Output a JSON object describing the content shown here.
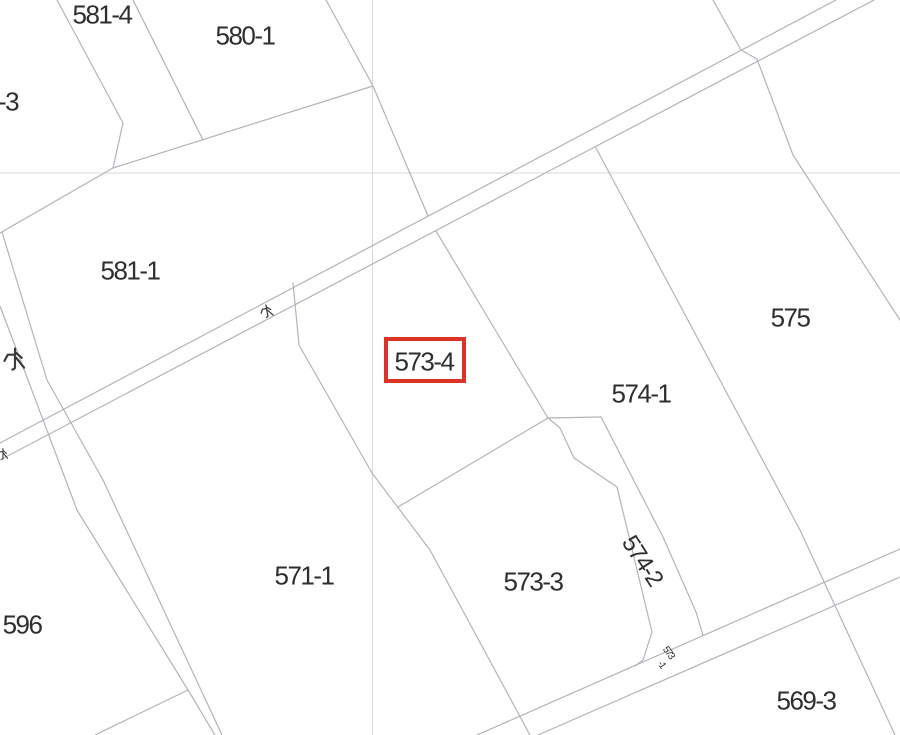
{
  "map": {
    "colors": {
      "background": "#ffffff",
      "boundary_line": "#b3b3b9",
      "grid_line": "#d9d9db",
      "label_text": "#2e2e2e",
      "highlight_red": "#dc3227"
    },
    "grid_lines": [
      {
        "name": "grid-vertical-line",
        "points": [
          [
            372.5,
            0
          ],
          [
            372.5,
            735
          ]
        ]
      },
      {
        "name": "grid-horizontal-line",
        "points": [
          [
            0,
            173
          ],
          [
            900,
            173
          ]
        ]
      }
    ],
    "boundaries": [
      {
        "name": "waterway-a-upper-line",
        "points": [
          [
            0,
            443
          ],
          [
            836,
            0
          ]
        ]
      },
      {
        "name": "waterway-a-lower-line",
        "points": [
          [
            0,
            460
          ],
          [
            874,
            0
          ]
        ]
      },
      {
        "name": "road-b-upper-line",
        "points": [
          [
            900,
            549
          ],
          [
            477,
            735
          ]
        ]
      },
      {
        "name": "road-b-lower-line",
        "points": [
          [
            900,
            577
          ],
          [
            538,
            735
          ]
        ]
      },
      {
        "name": "waterway-strip-west-line",
        "points": [
          [
            0,
            306
          ],
          [
            28,
            380
          ],
          [
            77,
            510
          ],
          [
            188,
            690
          ],
          [
            215,
            735
          ]
        ]
      },
      {
        "name": "waterway-strip-east-line",
        "points": [
          [
            2,
            232
          ],
          [
            47,
            380
          ],
          [
            103,
            480
          ],
          [
            222,
            735
          ]
        ]
      },
      {
        "name": "parcel-596-south-line",
        "points": [
          [
            188,
            690
          ],
          [
            95,
            735
          ]
        ]
      },
      {
        "name": "parcel-581-4-west-line",
        "points": [
          [
            57,
            0
          ],
          [
            123,
            123
          ],
          [
            113,
            168
          ]
        ]
      },
      {
        "name": "parcel-581-4-east-line",
        "points": [
          [
            133,
            0
          ],
          [
            203,
            140
          ]
        ]
      },
      {
        "name": "parcel-581-1-north-line",
        "points": [
          [
            0,
            233
          ],
          [
            113,
            168
          ],
          [
            373,
            86
          ]
        ]
      },
      {
        "name": "parcel-580-1-east-line",
        "points": [
          [
            326,
            0
          ],
          [
            373,
            86
          ],
          [
            428,
            216
          ]
        ]
      },
      {
        "name": "parcel-573-4-east-line",
        "points": [
          [
            436,
            231
          ],
          [
            548,
            418
          ]
        ]
      },
      {
        "name": "parcel-573-3-northwest-line",
        "points": [
          [
            548,
            418
          ],
          [
            398,
            507
          ]
        ]
      },
      {
        "name": "parcel-571-1-east-line",
        "points": [
          [
            293,
            283
          ],
          [
            299,
            345
          ],
          [
            372,
            473
          ],
          [
            430,
            550
          ],
          [
            530,
            735
          ]
        ]
      },
      {
        "name": "parcel-574-1-east-line",
        "points": [
          [
            596,
            148
          ],
          [
            800,
            530
          ],
          [
            895,
            735
          ]
        ]
      },
      {
        "name": "parcel-575-northeast-line",
        "points": [
          [
            713,
            0
          ],
          [
            741,
            50
          ],
          [
            757,
            59
          ],
          [
            793,
            155
          ],
          [
            900,
            320
          ]
        ]
      },
      {
        "name": "strip-574-2-west-line",
        "points": [
          [
            548,
            418
          ],
          [
            560,
            428
          ],
          [
            574,
            458
          ],
          [
            617,
            487
          ],
          [
            652,
            632
          ],
          [
            643,
            660
          ],
          [
            635,
            666
          ]
        ]
      },
      {
        "name": "strip-574-2-east-line",
        "points": [
          [
            601,
            417
          ],
          [
            663,
            537
          ],
          [
            696,
            612
          ],
          [
            703,
            635
          ]
        ]
      },
      {
        "name": "strip-574-2-top-line",
        "points": [
          [
            548,
            418
          ],
          [
            601,
            417
          ]
        ]
      }
    ],
    "highlight_box": {
      "x": 386,
      "y": 339,
      "width": 78,
      "height": 42,
      "color": "#dc3227"
    },
    "labels": [
      {
        "name": "parcel-label-581-4",
        "text": "581-4",
        "x": 102,
        "y": 14,
        "size": 26,
        "rotate": 0
      },
      {
        "name": "parcel-label-580-1",
        "text": "580-1",
        "x": 245,
        "y": 35,
        "size": 26,
        "rotate": 0
      },
      {
        "name": "parcel-label-3",
        "text": "-3",
        "x": 8,
        "y": 101,
        "size": 26,
        "rotate": 0
      },
      {
        "name": "parcel-label-581-1",
        "text": "581-1",
        "x": 130,
        "y": 270,
        "size": 26,
        "rotate": 0
      },
      {
        "name": "parcel-label-573-4",
        "text": "573-4",
        "x": 424,
        "y": 361,
        "size": 26,
        "rotate": 0
      },
      {
        "name": "parcel-label-574-1",
        "text": "574-1",
        "x": 641,
        "y": 393,
        "size": 26,
        "rotate": 0
      },
      {
        "name": "parcel-label-575",
        "text": "575",
        "x": 790,
        "y": 317,
        "size": 26,
        "rotate": 0
      },
      {
        "name": "parcel-label-571-1",
        "text": "571-1",
        "x": 304,
        "y": 575,
        "size": 26,
        "rotate": 0
      },
      {
        "name": "parcel-label-573-3",
        "text": "573-3",
        "x": 533,
        "y": 581,
        "size": 26,
        "rotate": 0
      },
      {
        "name": "parcel-label-596",
        "text": "596",
        "x": 22,
        "y": 624,
        "size": 26,
        "rotate": 0
      },
      {
        "name": "parcel-label-569-3",
        "text": "569-3",
        "x": 806,
        "y": 700,
        "size": 26,
        "rotate": 0
      },
      {
        "name": "parcel-label-574-2",
        "text": "574-2",
        "x": 643,
        "y": 560,
        "size": 24,
        "rotate": 57
      },
      {
        "name": "parcel-label-573-1-line1",
        "text": "573",
        "x": 669,
        "y": 652,
        "size": 10,
        "rotate": 55
      },
      {
        "name": "parcel-label-573-1-line2",
        "text": "-1",
        "x": 662,
        "y": 664,
        "size": 10,
        "rotate": 55
      }
    ],
    "water_marks": [
      {
        "name": "water-mark-strip",
        "glyph": "water",
        "x": 15,
        "y": 359,
        "size": 24,
        "rotate": 0
      },
      {
        "name": "water-mark-road-center",
        "glyph": "water",
        "x": 267,
        "y": 311,
        "size": 14,
        "rotate": -10
      },
      {
        "name": "water-mark-road-left",
        "glyph": "water",
        "x": 3,
        "y": 454,
        "size": 12,
        "rotate": 0
      }
    ]
  }
}
